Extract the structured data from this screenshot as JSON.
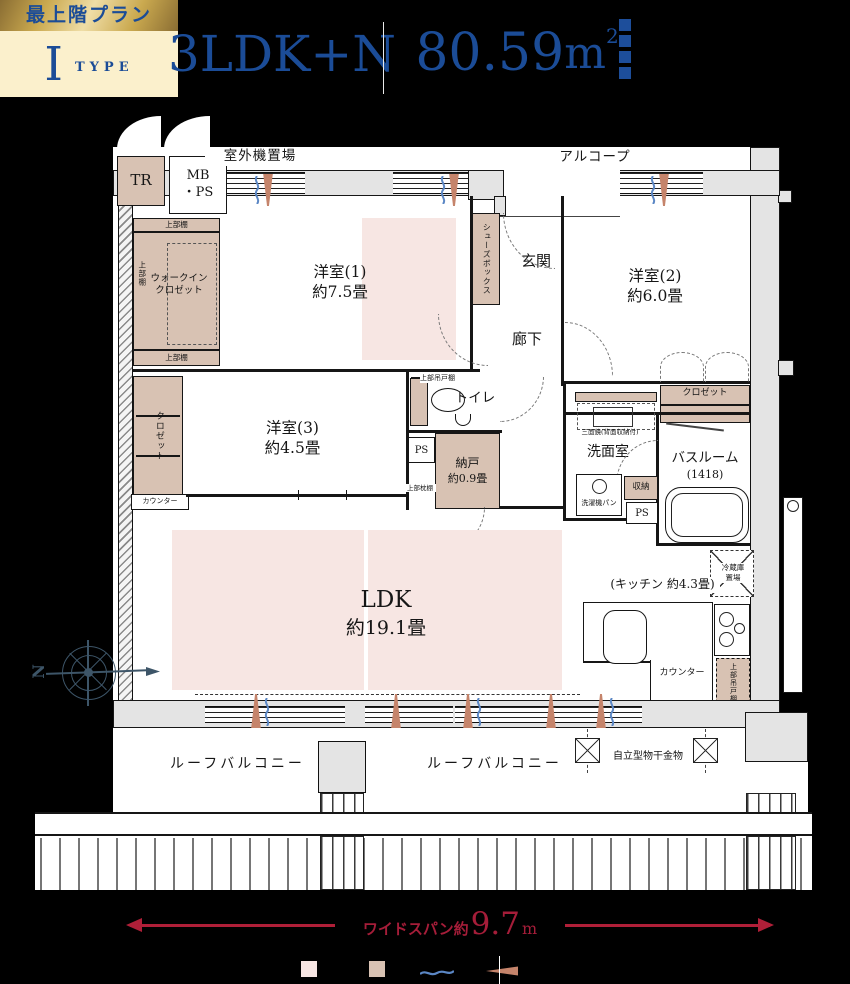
{
  "header": {
    "badge": {
      "top_label": "最上階プラン",
      "type_letter": "I",
      "type_word": "TYPE"
    },
    "plan_name": "3LDK+N",
    "area": {
      "value": "80.59",
      "unit": "m",
      "sup": "2"
    }
  },
  "colors": {
    "navy": "#1b4c97",
    "gold": "#9a7b3c",
    "cream": "#fbf0cc",
    "pink": "#f7e6e3",
    "tan": "#d8c2b3",
    "wall_gray": "#e4e4e4",
    "crimson": "#b01f38",
    "dark_red": "#a51d39",
    "compass": "#3d5568",
    "wave_blue": "#5b87c5",
    "cone_brown": "#c5846b"
  },
  "plan": {
    "outdoor_unit": "室外機置場",
    "alcove": "アルコープ",
    "tr": "TR",
    "mb": "MB",
    "ps_dot": "・PS",
    "upper_shelf": "上部棚",
    "wic": {
      "line1": "ウォークイン",
      "line2": "クロゼット"
    },
    "bedroom1": {
      "name": "洋室(1)",
      "size": "約7.5畳"
    },
    "bedroom2": {
      "name": "洋室(2)",
      "size": "約6.0畳"
    },
    "bedroom3": {
      "name": "洋室(3)",
      "size": "約4.5畳"
    },
    "shoes_box": "シューズボックス",
    "entrance": "玄関",
    "hallway": "廊下",
    "toilet": {
      "name": "トイレ",
      "upper": "上部吊戸棚"
    },
    "closet2": "クロゼット",
    "closet3": "クロゼット",
    "ps": "PS",
    "storage_room": {
      "name": "納戸",
      "size": "約0.9畳",
      "upper": "上部枕棚"
    },
    "counter_side": "カウンター",
    "washroom": {
      "mirror": "三面鏡(背面収納付)",
      "name": "洗面室",
      "washer": "洗濯機パン",
      "storage": "収納"
    },
    "bathroom": {
      "name": "バスルーム",
      "size": "(1418)"
    },
    "fridge": {
      "line1": "冷蔵庫",
      "line2": "置場"
    },
    "ldk": {
      "name": "LDK",
      "size": "約19.1畳"
    },
    "kitchen": {
      "label": "(キッチン 約4.3畳)",
      "counter": "カウンター",
      "upper": "上部吊戸棚"
    },
    "balcony": {
      "left": "ルーフバルコニー",
      "right": "ルーフバルコニー",
      "laundry": "自立型物干金物"
    },
    "compass_n": "N",
    "dimension": {
      "prefix": "ワイドスパン約",
      "value": "9.7",
      "unit": "m"
    }
  }
}
